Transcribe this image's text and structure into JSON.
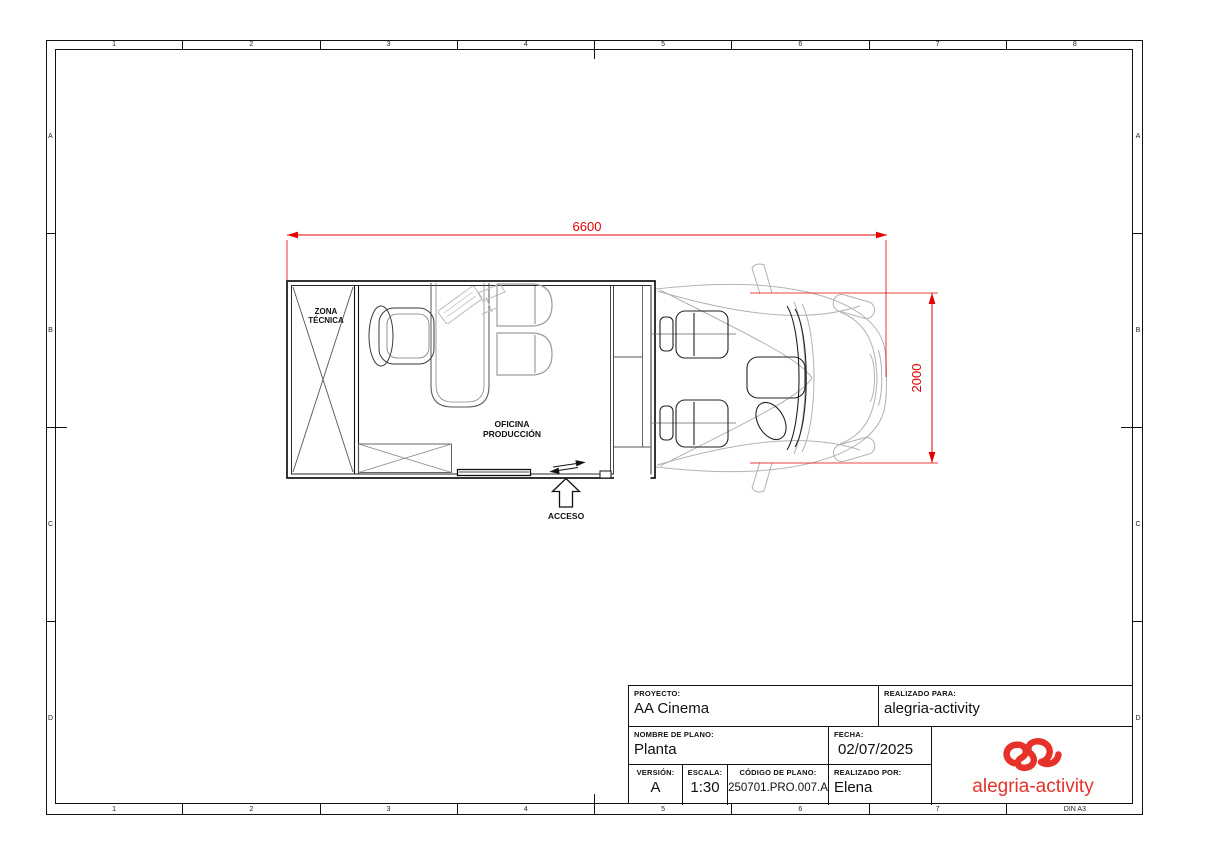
{
  "sheet": {
    "paper_size": "DIN A3",
    "ruler": {
      "top": [
        "1",
        "2",
        "3",
        "4",
        "5",
        "6",
        "7",
        "8"
      ],
      "bottom": [
        "1",
        "2",
        "3",
        "4",
        "5",
        "6",
        "7"
      ],
      "left": [
        "A",
        "B",
        "C",
        "D"
      ],
      "right": [
        "A",
        "B",
        "C",
        "D"
      ]
    }
  },
  "drawing": {
    "labels": {
      "zona_line1": "ZONA",
      "zona_line2": "TÉCNICA",
      "oficina_line1": "OFICINA",
      "oficina_line2": "PRODUCCIÓN",
      "acceso": "ACCESO"
    },
    "dimensions": {
      "length_mm": "6600",
      "width_mm": "2000"
    },
    "colors": {
      "dimension_red": "#e60000",
      "linework": "#1a1a1a",
      "light_gray": "#b0b0b0"
    }
  },
  "title_block": {
    "proyecto": {
      "label": "PROYECTO:",
      "value": "AA Cinema"
    },
    "realizado_para": {
      "label": "REALIZADO PARA:",
      "value": "alegria-activity"
    },
    "nombre_plano": {
      "label": "NOMBRE DE PLANO:",
      "value": "Planta"
    },
    "fecha": {
      "label": "FECHA:",
      "value": "02/07/2025"
    },
    "version": {
      "label": "VERSIÓN:",
      "value": "A"
    },
    "escala": {
      "label": "ESCALA:",
      "value": "1:30"
    },
    "codigo_plano": {
      "label": "CÓDIGO DE PLANO:",
      "value": "250701.PRO.007.A"
    },
    "realizado_por": {
      "label": "REALIZADO POR:",
      "value": "Elena"
    },
    "logo_text": "alegria-activity",
    "logo_color": "#e63229"
  }
}
